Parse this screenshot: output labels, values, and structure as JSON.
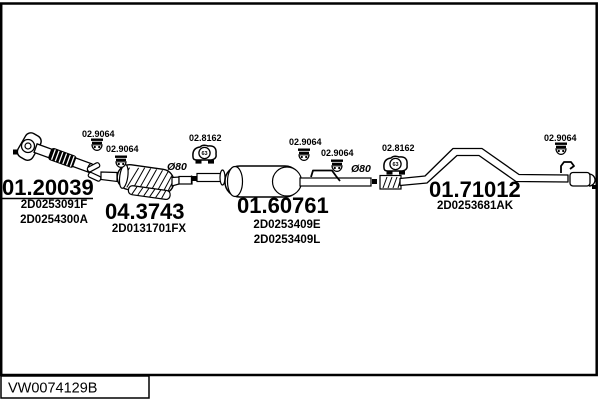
{
  "diagram": {
    "footer_code": "VW0074129B",
    "parts": {
      "front_pipe": {
        "code": "01.20039",
        "refs": [
          "2D0253091F",
          "2D0254300A"
        ]
      },
      "catalyst": {
        "code": "04.3743",
        "refs": [
          "2D0131701FX"
        ]
      },
      "centre_silencer": {
        "code": "01.60761",
        "refs": [
          "2D0253409E",
          "2D0253409L"
        ]
      },
      "tail_pipe": {
        "code": "01.71012",
        "refs": [
          "2D0253681AK"
        ]
      }
    },
    "fittings": {
      "clamp_code": "02.9064",
      "mount_code": "02.8162",
      "mount_size": "63",
      "pipe_diameter": "Ø80"
    },
    "colors": {
      "ink": "#000000",
      "paper": "#ffffff"
    }
  }
}
